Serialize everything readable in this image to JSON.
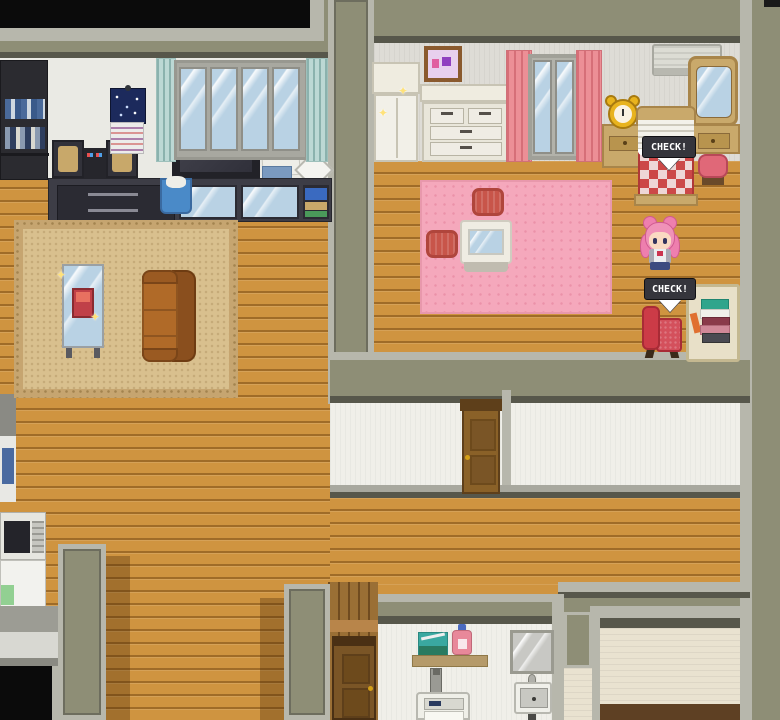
{
  "scene": {
    "title": "House interior - top-down RPG view",
    "prompts": [
      {
        "label": "CHECK!",
        "target": "bed"
      },
      {
        "label": "CHECK!",
        "target": "reading-chair"
      }
    ],
    "character": {
      "name": "pink-twintail-girl",
      "hair_color": "#ee7fae",
      "outfit": "school uniform with dark blue skirt",
      "location": "bedroom"
    },
    "rooms": {
      "living_room": {
        "furniture": [
          "dark-bookshelf",
          "stereo-set",
          "flat-tv",
          "media-cabinet",
          "star-poster",
          "wall-calendar",
          "large-window",
          "teal-curtains",
          "trash-bin",
          "tan-rug",
          "glass-display-table",
          "leather-sofa"
        ]
      },
      "bedroom": {
        "furniture": [
          "wardrobe",
          "dresser",
          "picture-frame",
          "window",
          "pink-curtains",
          "air-conditioner",
          "vanity-mirror",
          "vanity-table",
          "vanity-stool",
          "alarm-clock",
          "nightstand",
          "checkered-bed",
          "pink-rug",
          "floor-cushion",
          "floor-cushion",
          "low-glass-table",
          "reading-chair",
          "book-stack-desk"
        ]
      },
      "hallway": {
        "furniture": [
          "wooden-door"
        ]
      },
      "laundry_room": {
        "furniture": [
          "wall-shelf",
          "storage-box",
          "detergent-bottle",
          "washing-machine",
          "mirror",
          "sink",
          "wooden-door"
        ]
      },
      "lower_left_area": {
        "furniture": [
          "vending-machine",
          "microwave",
          "refrigerator",
          "counter",
          "dark-doorway"
        ]
      }
    },
    "palette": {
      "wood_floor": "#cf9440",
      "outer_wall": "#8e8e76",
      "wall_border": "#b7b7ac",
      "bedroom_wall": "#dedcd6",
      "living_wall": "#eaeae4",
      "hallway_wall": "#f0efe9",
      "cream_wall": "#e9e2d0",
      "bedroom_rug": "#f5a8bc",
      "living_rug": "#d9c08e",
      "blanket_check_red": "#cc4848",
      "curtain_pink": "#ec8f96",
      "curtain_teal": "#bcd8d4",
      "prompt_bg": "#35353c",
      "prompt_text": "#ffffff"
    }
  }
}
